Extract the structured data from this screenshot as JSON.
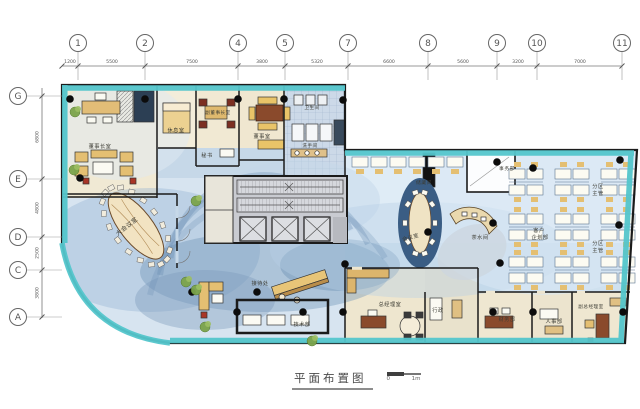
{
  "title_block": {
    "title": "平面布置图",
    "scale_zero": "0",
    "scale_unit": "1m"
  },
  "grid_top": {
    "bubble_cy": 43,
    "line_y": 66,
    "line_x1": 62,
    "line_x2": 622,
    "bubbles": [
      [
        "1",
        78
      ],
      [
        "2",
        145
      ],
      [
        "4",
        238
      ],
      [
        "5",
        285
      ],
      [
        "7",
        348
      ],
      [
        "8",
        428
      ],
      [
        "9",
        497
      ],
      [
        "10",
        537
      ],
      [
        "11",
        622
      ]
    ],
    "dims": [
      [
        "1200",
        70
      ],
      [
        "5500",
        112
      ],
      [
        "7500",
        192
      ],
      [
        "3800",
        262
      ],
      [
        "5320",
        317
      ],
      [
        "6600",
        389
      ],
      [
        "5600",
        463
      ],
      [
        "3200",
        518
      ],
      [
        "7000",
        580
      ]
    ]
  },
  "grid_left": {
    "bubble_cx": 18,
    "line_x": 42,
    "line_y1": 88,
    "line_y2": 318,
    "bubbles": [
      [
        "G",
        96
      ],
      [
        "E",
        179
      ],
      [
        "D",
        237
      ],
      [
        "C",
        270
      ],
      [
        "A",
        317
      ]
    ],
    "dims": [
      [
        "6800",
        137
      ],
      [
        "4800",
        208
      ],
      [
        "2500",
        253
      ],
      [
        "3800",
        293
      ]
    ]
  },
  "plan": {
    "room_labels": [
      {
        "t": "董事长室",
        "x": 100,
        "y": 148
      },
      {
        "t": "休息室",
        "x": 176,
        "y": 132
      },
      {
        "t": "副董事长室",
        "x": 218,
        "y": 114,
        "s": 4.6
      },
      {
        "t": "秘书",
        "x": 207,
        "y": 157
      },
      {
        "t": "董事室",
        "x": 262,
        "y": 138
      },
      {
        "t": "卫生间",
        "x": 312,
        "y": 109,
        "s": 4.6
      },
      {
        "t": "洗手间",
        "x": 310,
        "y": 147,
        "s": 4.6
      },
      {
        "t": "大会议室",
        "x": 128,
        "y": 228,
        "r": -38,
        "s": 6
      },
      {
        "t": "储藏间",
        "x": 424,
        "y": 184,
        "s": 4.8
      },
      {
        "t": "事务部",
        "x": 507,
        "y": 170,
        "s": 4.8
      },
      {
        "t": "会议室",
        "x": 411,
        "y": 239,
        "r": -15
      },
      {
        "t": "茶水间",
        "x": 480,
        "y": 239
      },
      {
        "t": "分区",
        "x": 598,
        "y": 188
      },
      {
        "t": "主管",
        "x": 598,
        "y": 195
      },
      {
        "t": "客户",
        "x": 539,
        "y": 232
      },
      {
        "t": "企划部",
        "x": 540,
        "y": 239
      },
      {
        "t": "分区",
        "x": 598,
        "y": 245
      },
      {
        "t": "主管",
        "x": 598,
        "y": 252
      },
      {
        "t": "接待处",
        "x": 260,
        "y": 285
      },
      {
        "t": "技术部",
        "x": 302,
        "y": 326
      },
      {
        "t": "总经理室",
        "x": 390,
        "y": 306
      },
      {
        "t": "行政",
        "x": 438,
        "y": 312
      },
      {
        "t": "财务部",
        "x": 507,
        "y": 321
      },
      {
        "t": "人事部",
        "x": 554,
        "y": 323
      },
      {
        "t": "副总经理室",
        "x": 591,
        "y": 308,
        "s": 4.6
      }
    ],
    "columns": [
      [
        70,
        99
      ],
      [
        145,
        99
      ],
      [
        238,
        99
      ],
      [
        284,
        99
      ],
      [
        343,
        100
      ],
      [
        80,
        178
      ],
      [
        192,
        292
      ],
      [
        237,
        312
      ],
      [
        303,
        312
      ],
      [
        343,
        312
      ],
      [
        493,
        312
      ],
      [
        533,
        312
      ],
      [
        623,
        312
      ],
      [
        497,
        162
      ],
      [
        620,
        160
      ],
      [
        619,
        225
      ],
      [
        493,
        223
      ],
      [
        345,
        264
      ],
      [
        500,
        263
      ],
      [
        257,
        292
      ],
      [
        533,
        168
      ],
      [
        428,
        232
      ]
    ],
    "plants": [
      [
        75,
        112
      ],
      [
        74,
        170
      ],
      [
        196,
        201
      ],
      [
        186,
        282
      ],
      [
        205,
        327
      ],
      [
        312,
        341
      ],
      [
        196,
        290
      ]
    ],
    "desk_clusters": [
      [
        526,
        182
      ],
      [
        572,
        182
      ],
      [
        618,
        182
      ],
      [
        526,
        227
      ],
      [
        572,
        227
      ],
      [
        618,
        227
      ],
      [
        526,
        270
      ],
      [
        572,
        270
      ],
      [
        618,
        270
      ]
    ],
    "top_desks": {
      "x0": 352,
      "y": 157,
      "count": 6,
      "step": 19
    },
    "oval_table": {
      "cx": 136,
      "cy": 226,
      "rx": 23,
      "ry": 46,
      "rot": -38,
      "chairs": 18
    },
    "round_table": {
      "cx": 420,
      "cy": 223,
      "rx": 15,
      "ry": 32,
      "chairs": 10
    },
    "colors": {
      "teal_window": "#54c6cc",
      "wall": "#1b1b1b",
      "floor_blue": "#d7e4f0",
      "beige_room": "#f0e9d4",
      "tan_furniture": "#e4bf72",
      "wood_brown": "#8a4a2c",
      "core_gray": "#c9cbd1",
      "carpet_navy": "#3a5d84",
      "plant_green": "#7ca44b",
      "column_black": "#0c0c0c",
      "red_accent": "#a93526"
    }
  }
}
